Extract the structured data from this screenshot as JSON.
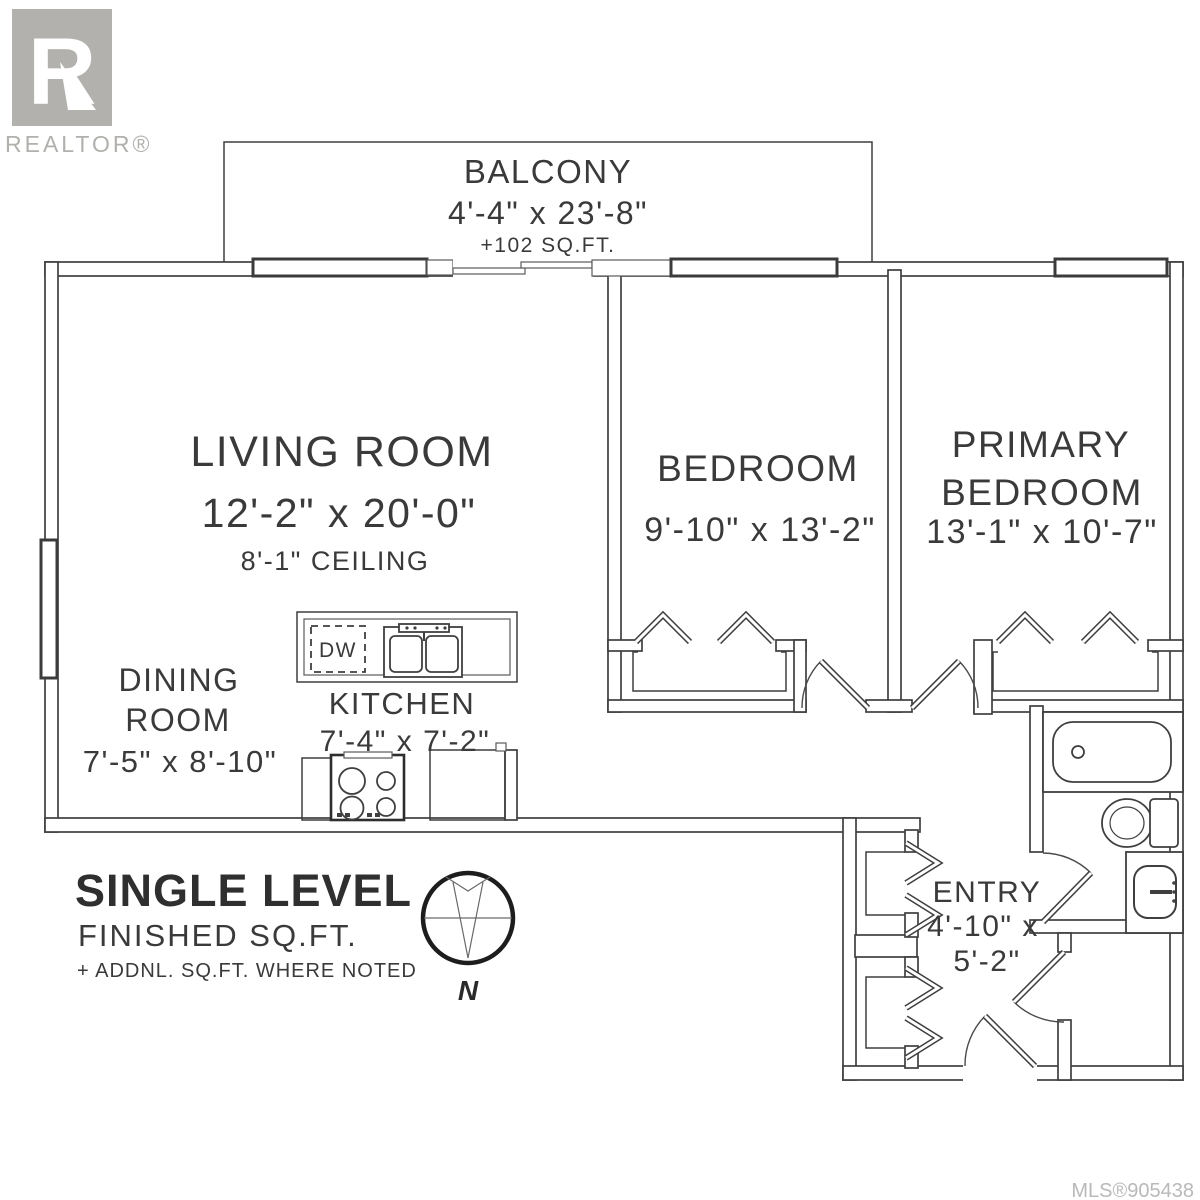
{
  "branding": {
    "logo_letter": "R",
    "logo_text": "REALTOR®",
    "mls": "MLS®905438"
  },
  "rooms": {
    "balcony": {
      "name": "BALCONY",
      "dim": "4'-4\" x 23'-8\"",
      "area": "+102 SQ.FT."
    },
    "living": {
      "name": "LIVING ROOM",
      "dim": "12'-2\" x 20'-0\"",
      "ceiling": "8'-1\" CEILING"
    },
    "bedroom": {
      "name": "BEDROOM",
      "dim": "9'-10\" x 13'-2\""
    },
    "primary": {
      "name_line1": "PRIMARY",
      "name_line2": "BEDROOM",
      "dim": "13'-1\" x 10'-7\""
    },
    "dining": {
      "name_line1": "DINING",
      "name_line2": "ROOM",
      "dim": "7'-5\" x 8'-10\""
    },
    "kitchen": {
      "name": "KITCHEN",
      "dim": "7'-4\" x 7'-2\"",
      "appliance": "DW"
    },
    "entry": {
      "name": "ENTRY",
      "dim_line1": "4'-10\" x",
      "dim_line2": "5'-2\""
    }
  },
  "legend": {
    "title": "SINGLE LEVEL",
    "subtitle": "FINISHED SQ.FT.",
    "note": "+ ADDNL. SQ.FT. WHERE NOTED"
  },
  "compass": {
    "label": "N"
  },
  "colors": {
    "line": "#3f3f3f",
    "text": "#3a3a3a",
    "muted": "#b2b1ae",
    "mls": "#b9b9b9"
  }
}
